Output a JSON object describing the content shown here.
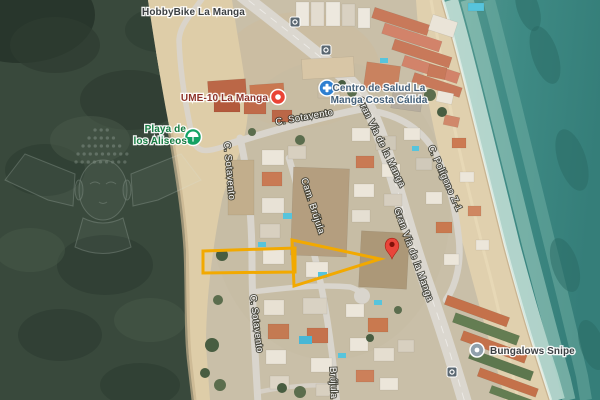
{
  "map": {
    "type": "satellite-view",
    "location_theme": "La Manga coastal strip",
    "pois": {
      "hobbybike": {
        "label": "HobbyBike La Manga",
        "label_color": "#3C4043"
      },
      "centro_salud": {
        "line1": "Centro de Salud La",
        "line2": "Manga Costa Cálida",
        "icon": "medical-cross-icon",
        "icon_color": "#2E7FD0",
        "label_color": "#44607A"
      },
      "ume10": {
        "label": "UME-10 La Manga",
        "icon": "red-dot-marker-icon",
        "icon_color": "#EA4335",
        "label_color": "#8E342B"
      },
      "playa_aliseos": {
        "line1": "Playa de",
        "line2": "los Aliseos",
        "icon": "beach-icon",
        "icon_color": "#12A264",
        "label_color": "#167C42"
      },
      "bungalows_snipe": {
        "label": "Bungalows Snipe",
        "icon": "poi-dot-icon",
        "icon_color": "#90A0AC",
        "label_color": "#3C4043"
      }
    },
    "streets": {
      "sotavento_top": "C. Sotavento",
      "sotavento_left": "C. Sotavento",
      "sotavento_lower": "C. Sotavento",
      "gran_via_upper": "Gran Vía de la Manga",
      "gran_via_lower": "Gran Vía de la Manga",
      "poligono": "C. Polígono Z-1",
      "brujula": "Cam. Brújula",
      "brujula_bottom": "Brújula"
    },
    "markers": {
      "dropped_pin": {
        "icon": "map-pin-icon",
        "color": "#E9453A"
      }
    },
    "transit": {
      "bus_stop_icons": 3
    },
    "annotation": {
      "type": "arrow-and-bar-outline",
      "color": "#F2A900"
    },
    "colors": {
      "sea": "#3E8A84",
      "surf_foam": "#D8ECE3",
      "sand": "#E0D0AE",
      "marsh_green": "#39493C",
      "road": "#DBD7CF",
      "urban_ground": "#C9BFA8"
    }
  }
}
